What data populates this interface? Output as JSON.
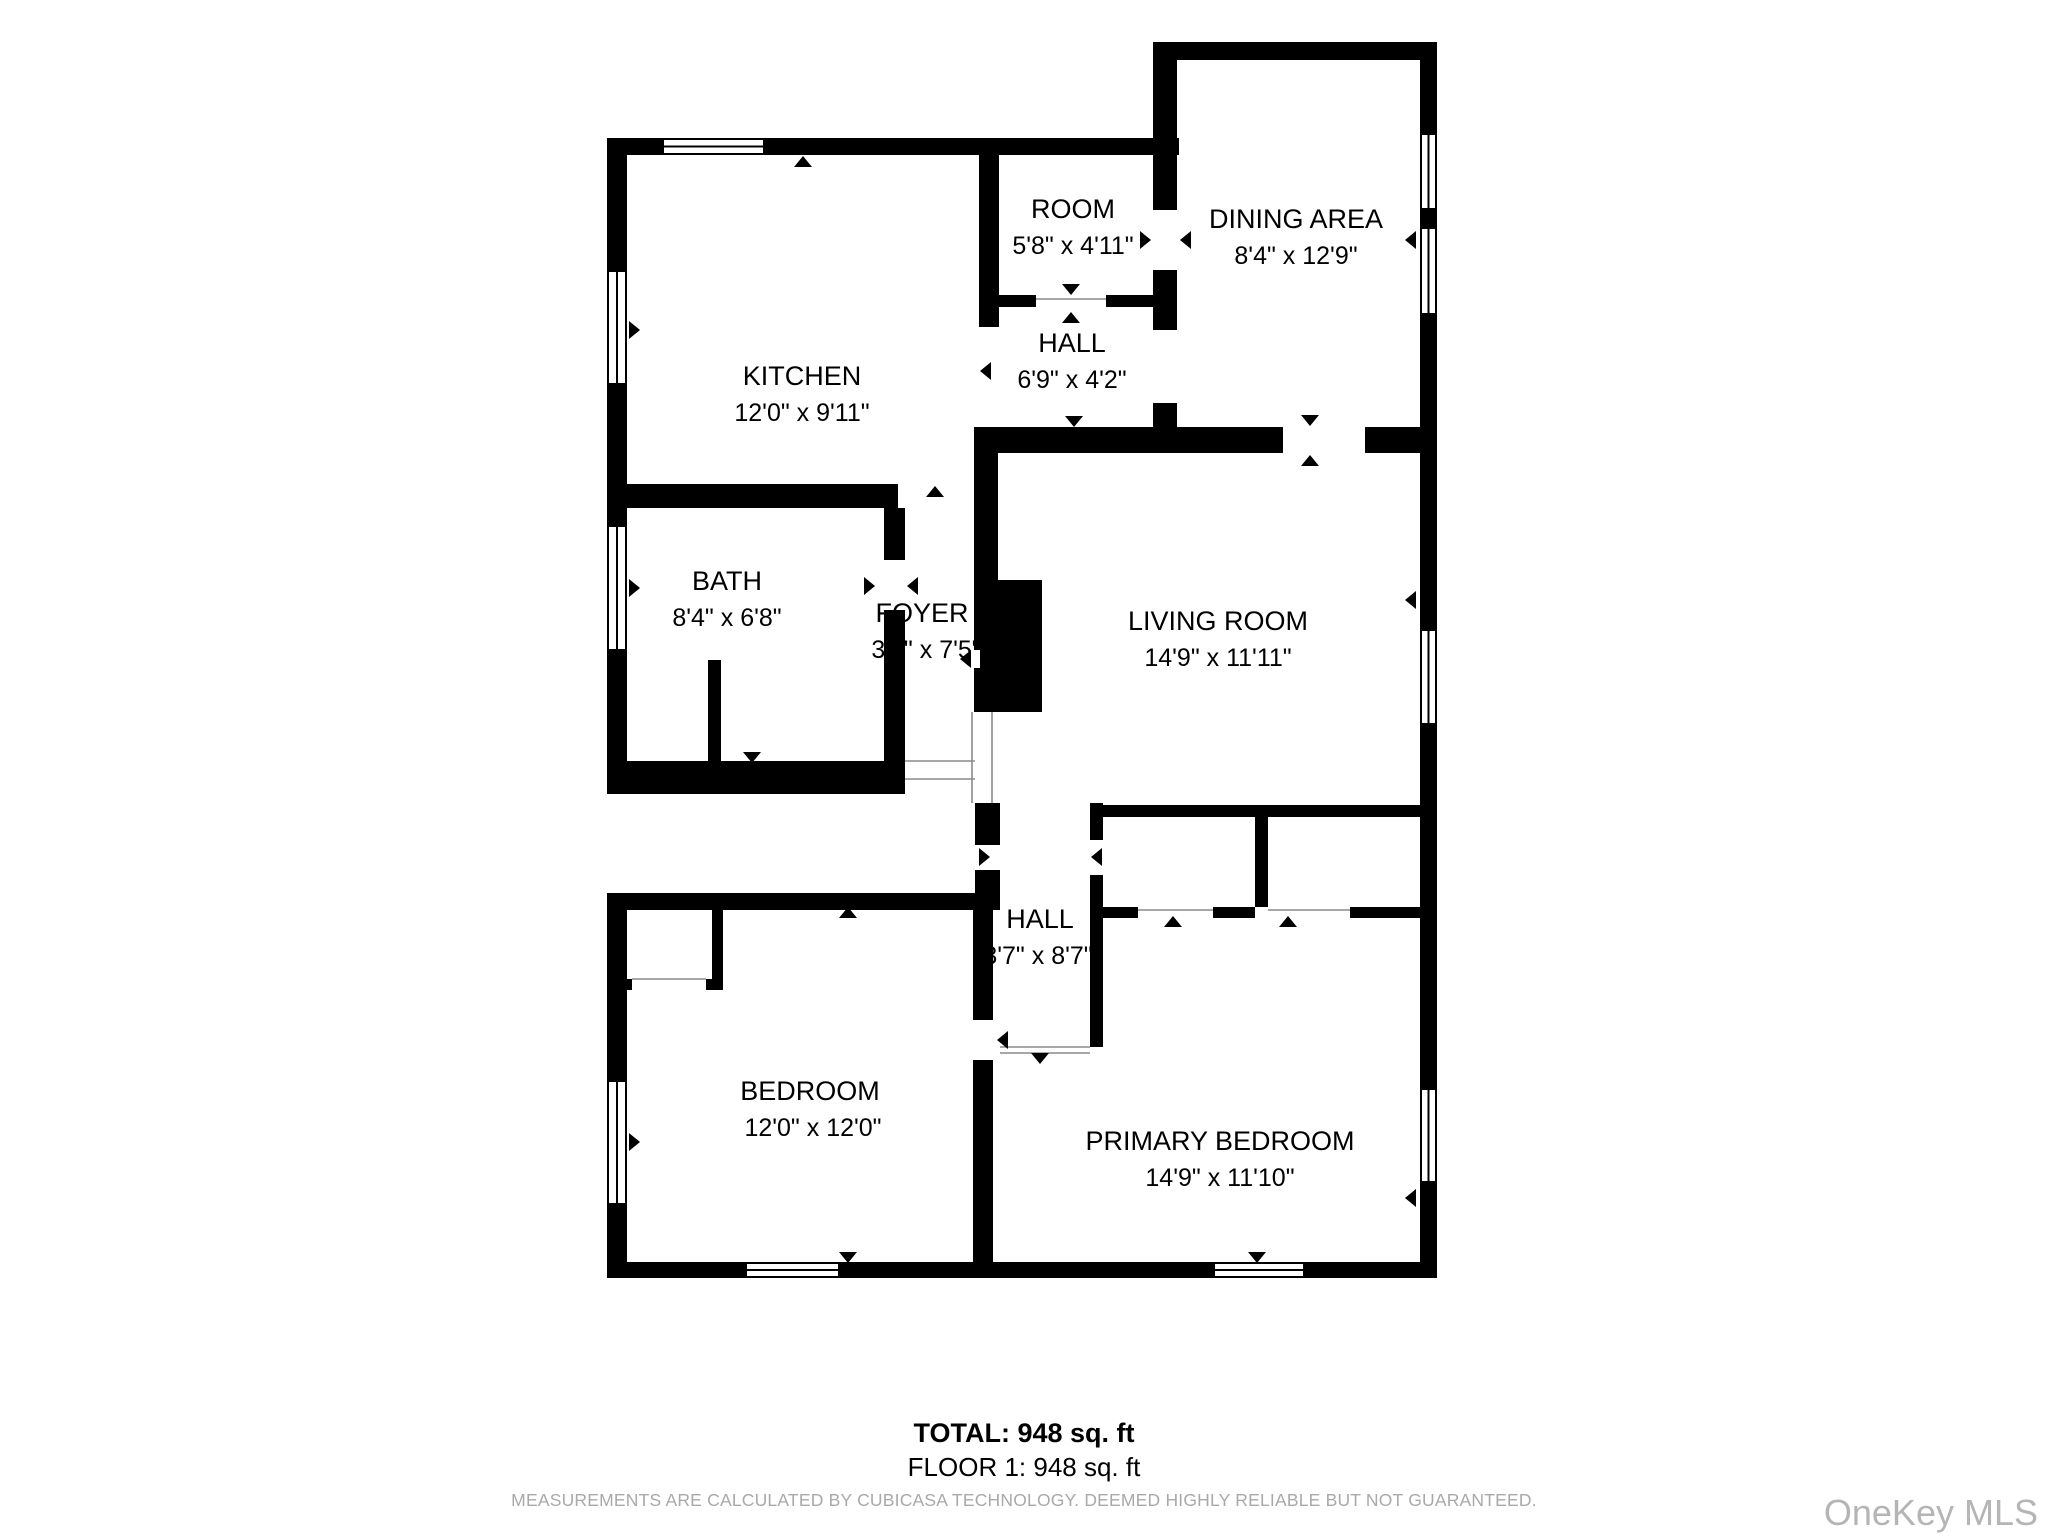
{
  "footer": {
    "total": "TOTAL: 948 sq. ft",
    "floor": "FLOOR 1: 948 sq. ft",
    "disclaimer": "MEASUREMENTS ARE CALCULATED BY CUBICASA TECHNOLOGY. DEEMED HIGHLY RELIABLE BUT NOT GUARANTEED.",
    "watermark": "OneKey MLS"
  },
  "plan": {
    "canvas": {
      "w": 2048,
      "h": 1536
    },
    "colors": {
      "wall": "#000000",
      "bg": "#ffffff",
      "label": "#000000",
      "thin": "#8a8a8a"
    },
    "rooms": [
      {
        "id": "kitchen",
        "name": "KITCHEN",
        "dims": "12'0\" x 9'11\"",
        "tx": 802,
        "ty": 385,
        "dx": 802,
        "dy": 421
      },
      {
        "id": "room",
        "name": "ROOM",
        "dims": "5'8\" x 4'11\"",
        "tx": 1073,
        "ty": 218,
        "dx": 1073,
        "dy": 254
      },
      {
        "id": "dining-area",
        "name": "DINING AREA",
        "dims": "8'4\" x 12'9\"",
        "tx": 1296,
        "ty": 228,
        "dx": 1296,
        "dy": 264
      },
      {
        "id": "hall-upper",
        "name": "HALL",
        "dims": "6'9\" x 4'2\"",
        "tx": 1072,
        "ty": 352,
        "dx": 1072,
        "dy": 388
      },
      {
        "id": "bath",
        "name": "BATH",
        "dims": "8'4\" x 6'8\"",
        "tx": 727,
        "ty": 590,
        "dx": 727,
        "dy": 626
      },
      {
        "id": "foyer",
        "name": "FOYER",
        "dims": "3'4\" x 7'5\"",
        "tx": 922,
        "ty": 622,
        "dx": 926,
        "dy": 658
      },
      {
        "id": "living-room",
        "name": "LIVING ROOM",
        "dims": "14'9\" x 11'11\"",
        "tx": 1218,
        "ty": 630,
        "dx": 1218,
        "dy": 666
      },
      {
        "id": "hall-lower",
        "name": "HALL",
        "dims": "3'7\" x 8'7\"",
        "tx": 1040,
        "ty": 928,
        "dx": 1038,
        "dy": 964
      },
      {
        "id": "bedroom",
        "name": "BEDROOM",
        "dims": "12'0\" x 12'0\"",
        "tx": 810,
        "ty": 1100,
        "dx": 813,
        "dy": 1136
      },
      {
        "id": "primary-bedroom",
        "name": "PRIMARY BEDROOM",
        "dims": "14'9\" x 11'10\"",
        "tx": 1220,
        "ty": 1150,
        "dx": 1220,
        "dy": 1186
      }
    ],
    "walls": [
      [
        607,
        138,
        572,
        17
      ],
      [
        1153,
        42,
        284,
        18
      ],
      [
        1420,
        42,
        17,
        1236
      ],
      [
        607,
        1262,
        830,
        16
      ],
      [
        607,
        138,
        20,
        656
      ],
      [
        607,
        893,
        20,
        385
      ],
      [
        607,
        761,
        298,
        33
      ],
      [
        1153,
        60,
        24,
        150
      ],
      [
        1153,
        270,
        24,
        60
      ],
      [
        1153,
        403,
        24,
        50
      ],
      [
        979,
        155,
        20,
        172
      ],
      [
        607,
        484,
        291,
        24
      ],
      [
        999,
        295,
        37,
        12
      ],
      [
        1106,
        295,
        47,
        12
      ],
      [
        974,
        427,
        309,
        26
      ],
      [
        1365,
        427,
        55,
        26
      ],
      [
        974,
        453,
        24,
        127
      ],
      [
        884,
        508,
        21,
        52
      ],
      [
        884,
        610,
        21,
        151
      ],
      [
        708,
        660,
        13,
        101
      ],
      [
        975,
        803,
        25,
        42
      ],
      [
        975,
        870,
        25,
        23
      ],
      [
        607,
        893,
        393,
        17
      ],
      [
        712,
        908,
        11,
        71
      ],
      [
        618,
        979,
        14,
        11
      ],
      [
        706,
        979,
        17,
        11
      ],
      [
        973,
        910,
        20,
        110
      ],
      [
        973,
        1060,
        20,
        202
      ],
      [
        1090,
        803,
        13,
        37
      ],
      [
        1090,
        875,
        13,
        172
      ],
      [
        1093,
        805,
        327,
        12
      ],
      [
        1255,
        817,
        13,
        90
      ],
      [
        1090,
        907,
        48,
        11
      ],
      [
        1213,
        907,
        42,
        11
      ],
      [
        1350,
        907,
        70,
        11
      ]
    ],
    "block": [
      974,
      580,
      68,
      132
    ],
    "slits": [
      [
        971,
        650,
        9,
        18
      ]
    ],
    "windows": [
      {
        "o": "h",
        "r": [
          657,
          138,
          113,
          17
        ]
      },
      {
        "o": "v",
        "r": [
          607,
          265,
          20,
          125
        ]
      },
      {
        "o": "v",
        "r": [
          607,
          520,
          20,
          136
        ]
      },
      {
        "o": "v",
        "r": [
          607,
          1075,
          20,
          135
        ]
      },
      {
        "o": "h",
        "r": [
          740,
          1262,
          105,
          16
        ]
      },
      {
        "o": "h",
        "r": [
          1208,
          1262,
          102,
          16
        ]
      },
      {
        "o": "v",
        "r": [
          1420,
          128,
          17,
          87
        ]
      },
      {
        "o": "v",
        "r": [
          1420,
          222,
          17,
          98
        ]
      },
      {
        "o": "v",
        "r": [
          1420,
          624,
          17,
          106
        ]
      },
      {
        "o": "v",
        "r": [
          1420,
          1083,
          17,
          105
        ]
      }
    ],
    "thin_lines": [
      [
        905,
        761,
        975,
        761
      ],
      [
        905,
        779,
        975,
        779
      ],
      [
        972,
        712,
        972,
        803
      ],
      [
        992,
        712,
        992,
        803
      ],
      [
        1000,
        1047,
        1090,
        1047
      ],
      [
        1000,
        1053,
        1090,
        1053
      ],
      [
        632,
        979,
        706,
        979
      ],
      [
        1036,
        299,
        1106,
        299
      ],
      [
        1138,
        910,
        1213,
        910
      ],
      [
        1268,
        910,
        1350,
        910
      ]
    ],
    "triangles": [
      {
        "d": "up",
        "x": 803,
        "y": 162
      },
      {
        "d": "up",
        "x": 935,
        "y": 492
      },
      {
        "d": "down",
        "x": 1071,
        "y": 289
      },
      {
        "d": "up",
        "x": 1071,
        "y": 318
      },
      {
        "d": "right",
        "x": 1145,
        "y": 240
      },
      {
        "d": "left",
        "x": 1186,
        "y": 240
      },
      {
        "d": "left",
        "x": 986,
        "y": 371
      },
      {
        "d": "down",
        "x": 1310,
        "y": 420
      },
      {
        "d": "up",
        "x": 1310,
        "y": 461
      },
      {
        "d": "right",
        "x": 869,
        "y": 586
      },
      {
        "d": "left",
        "x": 913,
        "y": 586
      },
      {
        "d": "right",
        "x": 634,
        "y": 330
      },
      {
        "d": "right",
        "x": 634,
        "y": 588
      },
      {
        "d": "right",
        "x": 634,
        "y": 1142
      },
      {
        "d": "left",
        "x": 1411,
        "y": 240
      },
      {
        "d": "left",
        "x": 1411,
        "y": 600
      },
      {
        "d": "left",
        "x": 1411,
        "y": 1198
      },
      {
        "d": "down",
        "x": 848,
        "y": 1257
      },
      {
        "d": "down",
        "x": 1257,
        "y": 1257
      },
      {
        "d": "up",
        "x": 848,
        "y": 913
      },
      {
        "d": "right",
        "x": 984,
        "y": 857
      },
      {
        "d": "left",
        "x": 1097,
        "y": 857
      },
      {
        "d": "down",
        "x": 1040,
        "y": 1058
      },
      {
        "d": "up",
        "x": 1173,
        "y": 922
      },
      {
        "d": "up",
        "x": 1288,
        "y": 922
      },
      {
        "d": "left",
        "x": 1003,
        "y": 1040
      },
      {
        "d": "down",
        "x": 1074,
        "y": 421
      },
      {
        "d": "left",
        "x": 966,
        "y": 659
      },
      {
        "d": "down",
        "x": 752,
        "y": 757
      }
    ]
  }
}
